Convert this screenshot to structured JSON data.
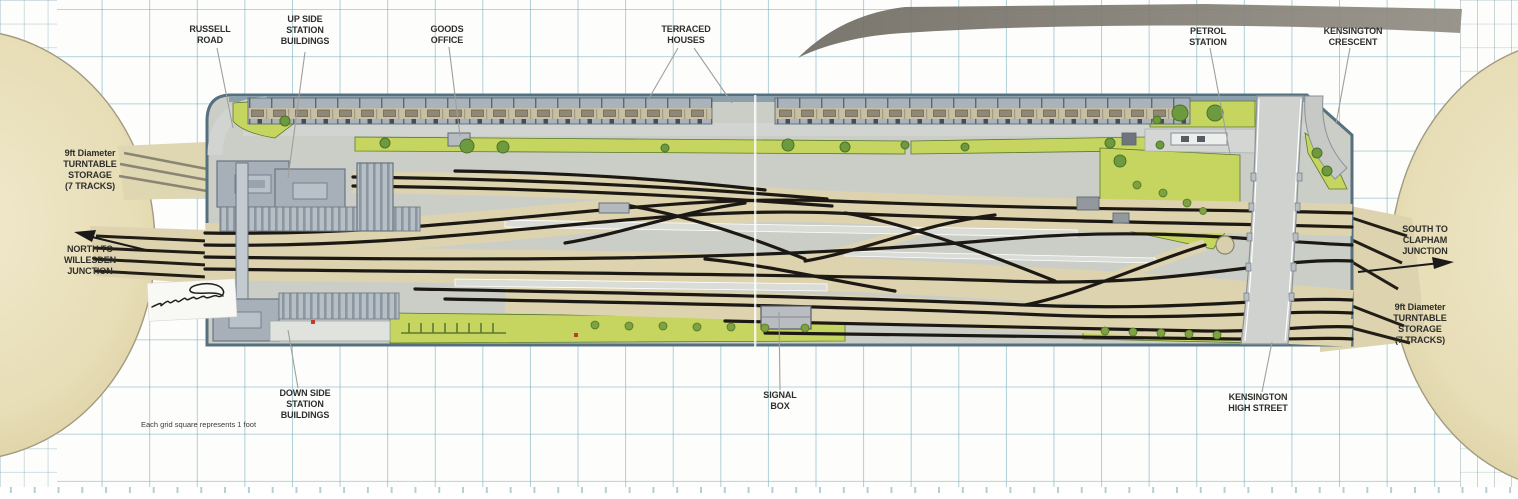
{
  "plan": {
    "grid_note": "Each grid square represents 1 foot",
    "annotations": {
      "russell_road": "RUSSELL\nROAD",
      "up_side_station_buildings": "UP SIDE\nSTATION\nBUILDINGS",
      "goods_office": "GOODS\nOFFICE",
      "terraced_houses": "TERRACED\nHOUSES",
      "petrol_station": "PETROL\nSTATION",
      "kensington_crescent": "KENSINGTON\nCRESCENT",
      "turntable_storage_left": "9ft Diameter\nTURNTABLE\nSTORAGE\n(7 TRACKS)",
      "north_to_willesden_junction": "NORTH TO\nWILLESDEN\nJUNCTION",
      "south_to_clapham_junction": "SOUTH TO\nCLAPHAM\nJUNCTION",
      "turntable_storage_right": "9ft Diameter\nTURNTABLE\nSTORAGE\n(7 TRACKS)",
      "down_side_station_buildings": "DOWN SIDE\nSTATION\nBUILDINGS",
      "signal_box": "SIGNAL\nBOX",
      "kensington_high_street": "KENSINGTON\nHIGH STREET"
    },
    "colors": {
      "grid_line": "#6eaab8",
      "board_surface": "#cbcdc7",
      "board_edge": "#55707e",
      "ballast_beige": "#ddd3ae",
      "turntable_cream": "#e9e0bc",
      "grass_green": "#c6d55f",
      "tree_green": "#6d9a3e",
      "track_black": "#1c1813",
      "roof_grey": "#a7b0b9",
      "road_grey": "#d2d4d1"
    }
  }
}
